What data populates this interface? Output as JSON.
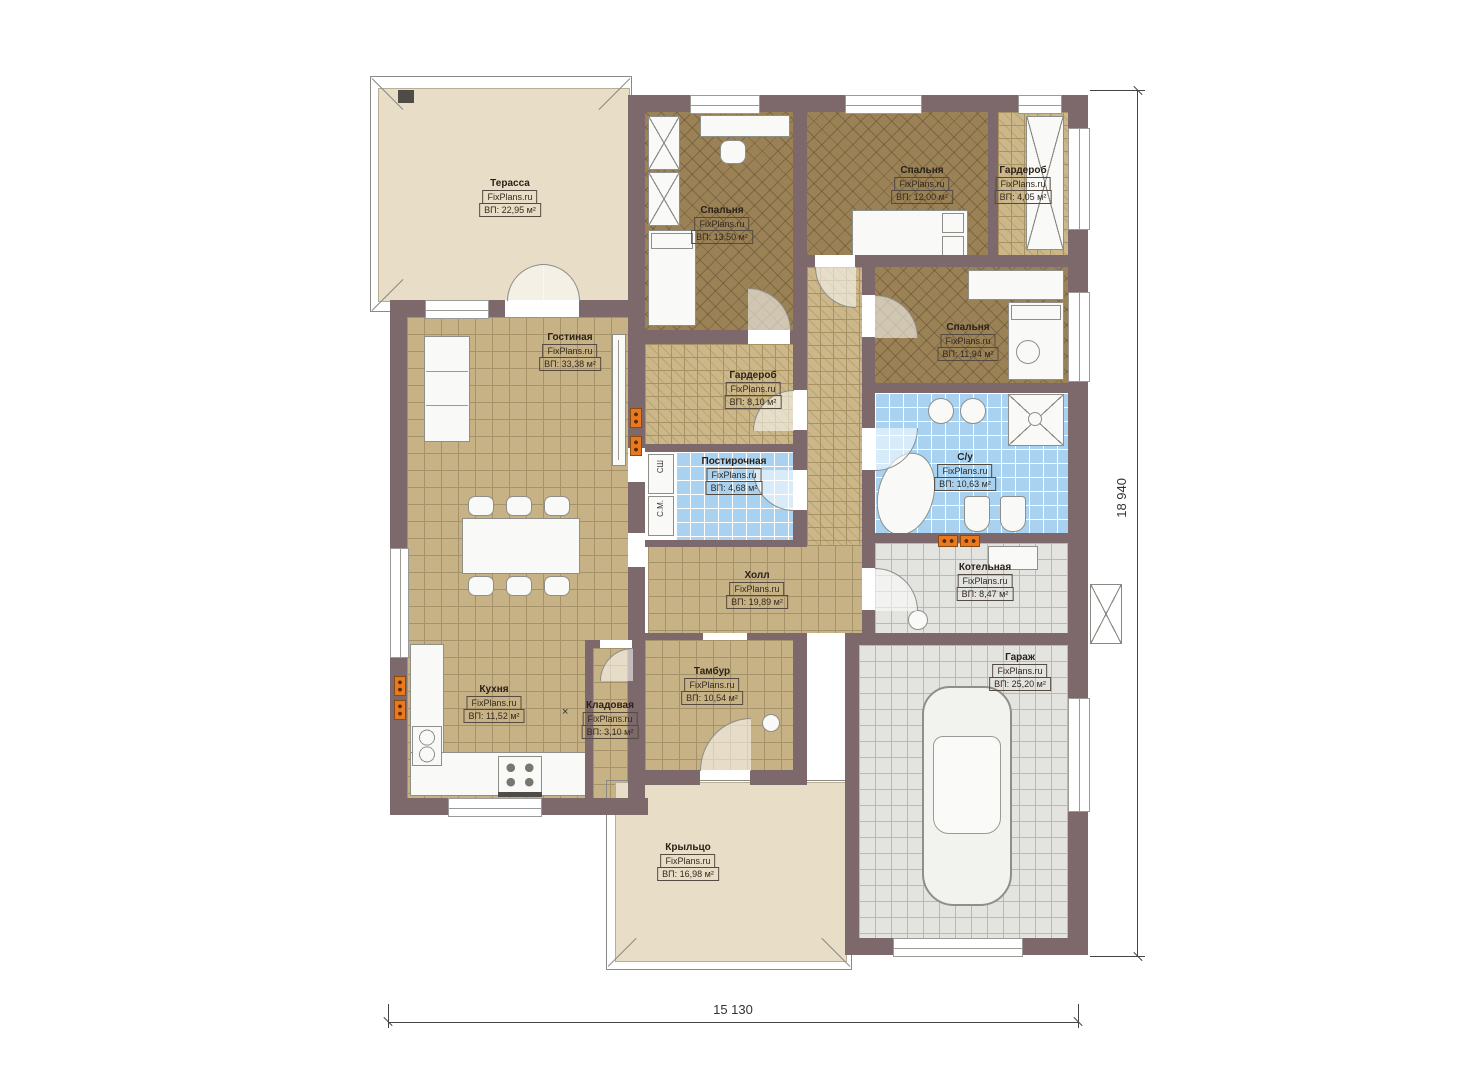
{
  "plan": {
    "watermark": "FixPlans.ru",
    "rooms": [
      {
        "id": "terrace",
        "name": "Терасса",
        "area": "ВП: 22,95 м²"
      },
      {
        "id": "bedroom1",
        "name": "Спальня",
        "area": "ВП: 13,50 м²"
      },
      {
        "id": "bedroom2",
        "name": "Спальня",
        "area": "ВП: 12,00 м²"
      },
      {
        "id": "wardrobe1",
        "name": "Гардероб",
        "area": "ВП: 4,05 м²"
      },
      {
        "id": "bedroom3",
        "name": "Спальня",
        "area": "ВП: 11,94 м²"
      },
      {
        "id": "living",
        "name": "Гостиная",
        "area": "ВП: 33,38 м²"
      },
      {
        "id": "wardrobe2",
        "name": "Гардероб",
        "area": "ВП: 8,10 м²"
      },
      {
        "id": "laundry",
        "name": "Постирочная",
        "area": "ВП: 4,68 м²"
      },
      {
        "id": "bathroom",
        "name": "С/у",
        "area": "ВП: 10,63 м²"
      },
      {
        "id": "hall",
        "name": "Холл",
        "area": "ВП: 19,89 м²"
      },
      {
        "id": "boiler",
        "name": "Котельная",
        "area": "ВП: 8,47 м²"
      },
      {
        "id": "kitchen",
        "name": "Кухня",
        "area": "ВП: 11,52 м²"
      },
      {
        "id": "pantry",
        "name": "Кладовая",
        "area": "ВП: 3,10 м²"
      },
      {
        "id": "vestibule",
        "name": "Тамбур",
        "area": "ВП: 10,54 м²"
      },
      {
        "id": "garage",
        "name": "Гараж",
        "area": "ВП: 25,20 м²"
      },
      {
        "id": "porch",
        "name": "Крыльцо",
        "area": "ВП: 16,98 м²"
      }
    ],
    "appliances": {
      "dryer": "СШ",
      "washer": "С.М."
    },
    "pantry_mark": "×",
    "dimensions": {
      "bottom": "15 130",
      "right": "18 940"
    },
    "colors": {
      "wall": "#7d686b",
      "tile": "#c7b285",
      "bedroom_floor": "#9a8156",
      "wet_floor": "#a8d2f0",
      "utility_floor": "#e3e3e0",
      "terrace_floor": "#e8ddc6",
      "radiator": "#e8791e"
    }
  }
}
